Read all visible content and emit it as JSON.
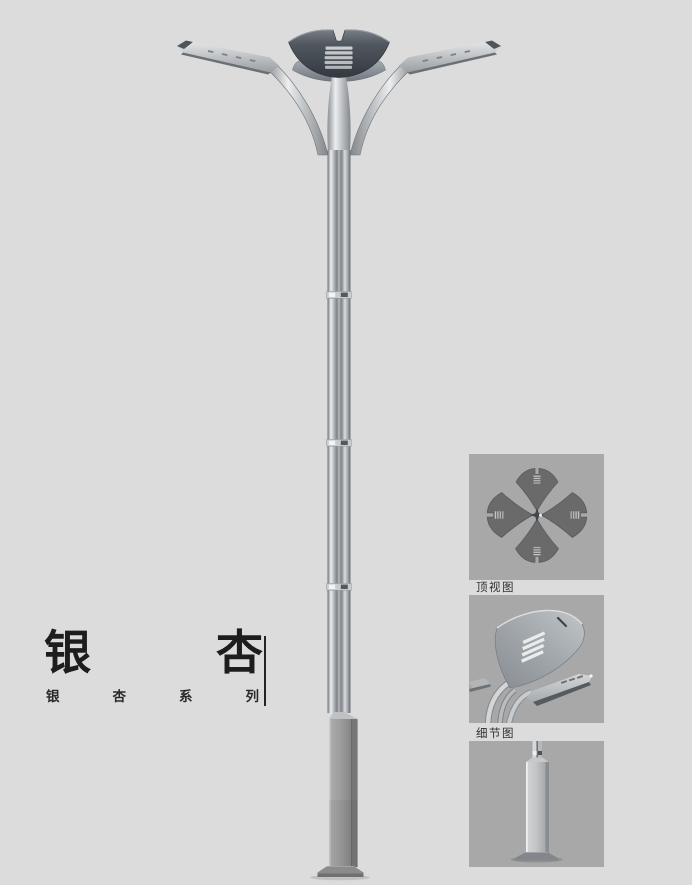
{
  "page": {
    "cropped_top_text": "···········································",
    "background_color": "#dcdcdc"
  },
  "product": {
    "title": "银杏",
    "title_chars": [
      "银",
      "杏"
    ],
    "series": "银杏系列",
    "series_chars": [
      "银",
      "杏",
      "系",
      "列"
    ]
  },
  "gallery": {
    "top_view_caption": "顶视图",
    "detail_view_caption": "细节图"
  },
  "colors": {
    "page_background": "#dcdcdc",
    "panel_background": "#a8a8a8",
    "title_text": "#1d1d1d",
    "caption_text": "#2f2f2f",
    "lamp_crown_dark": "#3c424a",
    "lamp_metal_light": "#eceeef",
    "lamp_metal_mid": "#aeb2b6",
    "lamp_base_gray": "#8f8f8f"
  }
}
